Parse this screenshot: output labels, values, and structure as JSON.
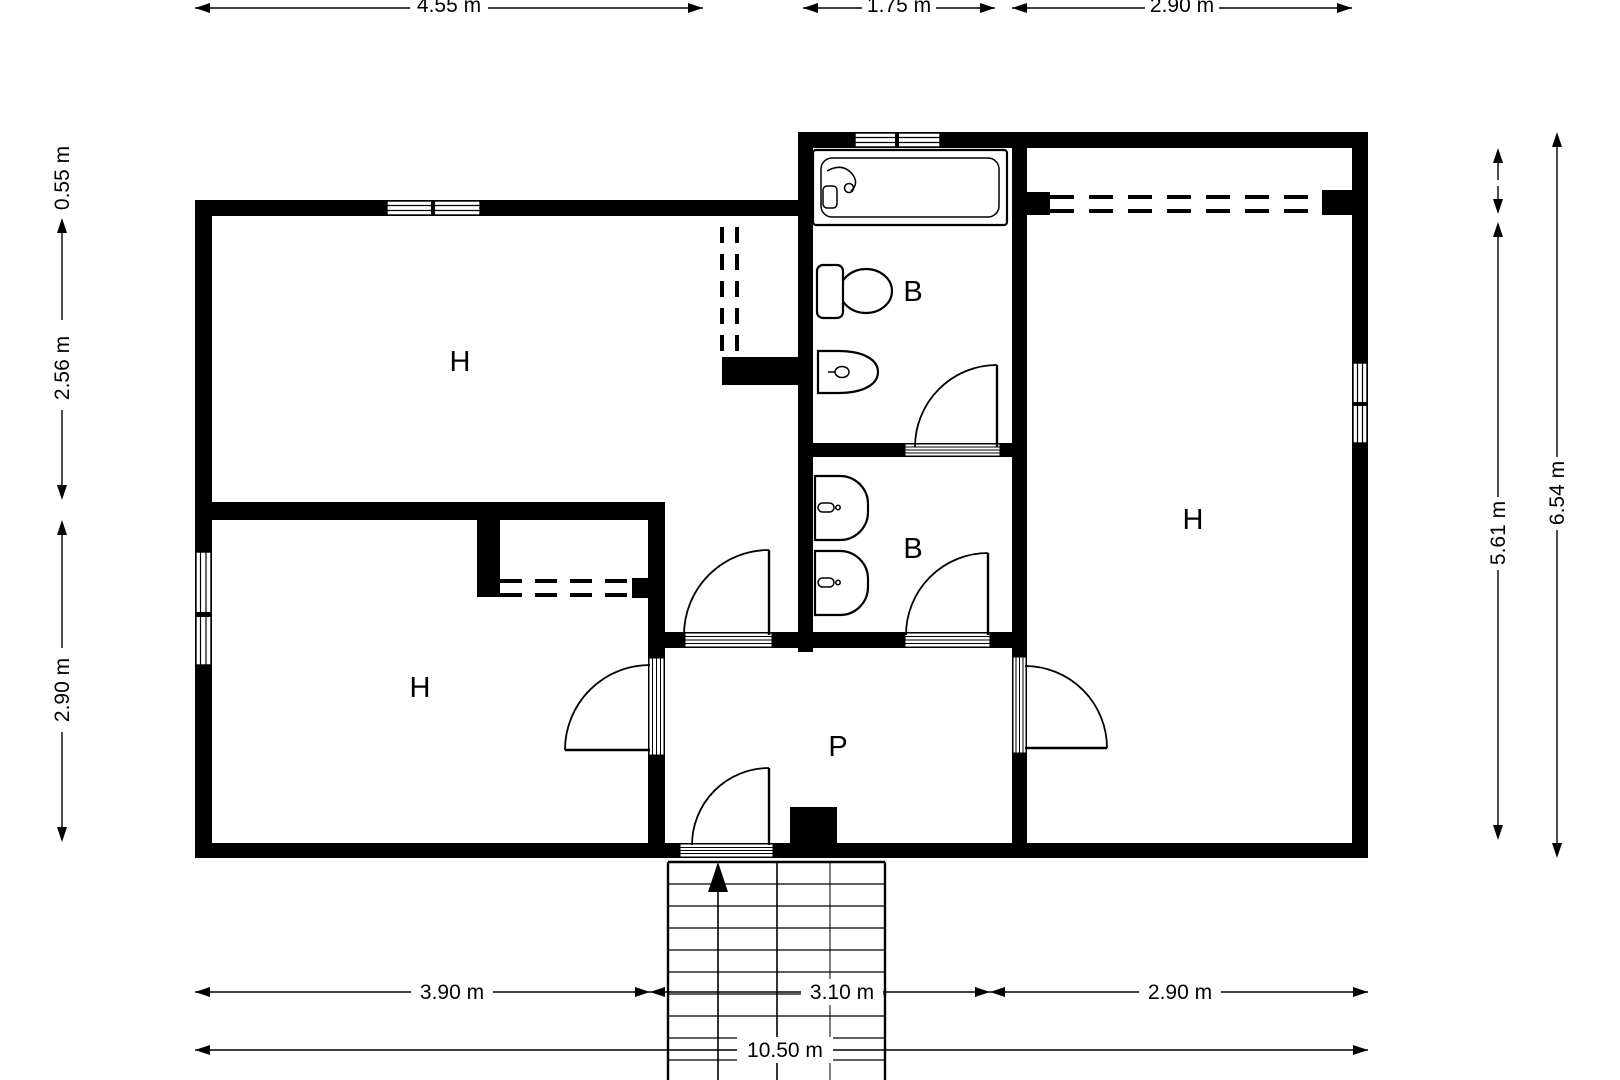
{
  "plan": {
    "room_labels": {
      "top_left": "H",
      "bottom_left": "H",
      "right": "H",
      "bathroom_top": "B",
      "bathroom_middle": "B",
      "hall": "P"
    },
    "dimensions": {
      "top": [
        "4.55 m",
        "1.75 m",
        "2.90 m"
      ],
      "left": [
        "0.55 m",
        "2.56 m",
        "2.90 m"
      ],
      "right_inner": "5.61 m",
      "right_outer": "6.54 m",
      "bottom": [
        "3.90 m",
        "3.10 m",
        "2.90 m"
      ],
      "bottom_total": "10.50 m"
    },
    "colors": {
      "wall": "#000000",
      "background": "#ffffff"
    }
  }
}
